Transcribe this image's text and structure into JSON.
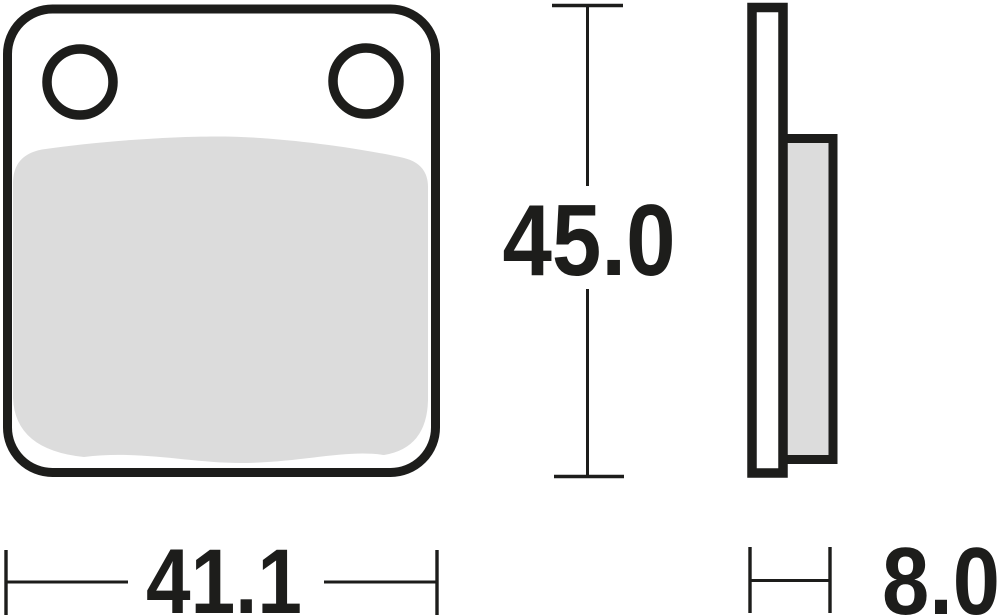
{
  "drawing": {
    "type": "dimensioned technical drawing",
    "subject": "disc brake pad, front view and side profile view",
    "dimensions": {
      "width": {
        "value": "41.1"
      },
      "height": {
        "value": "45.0"
      },
      "thickness": {
        "value": "8.0"
      }
    },
    "colors": {
      "line": "#1d1d1b",
      "friction": "#dcdcdc",
      "background": "#ffffff"
    }
  }
}
